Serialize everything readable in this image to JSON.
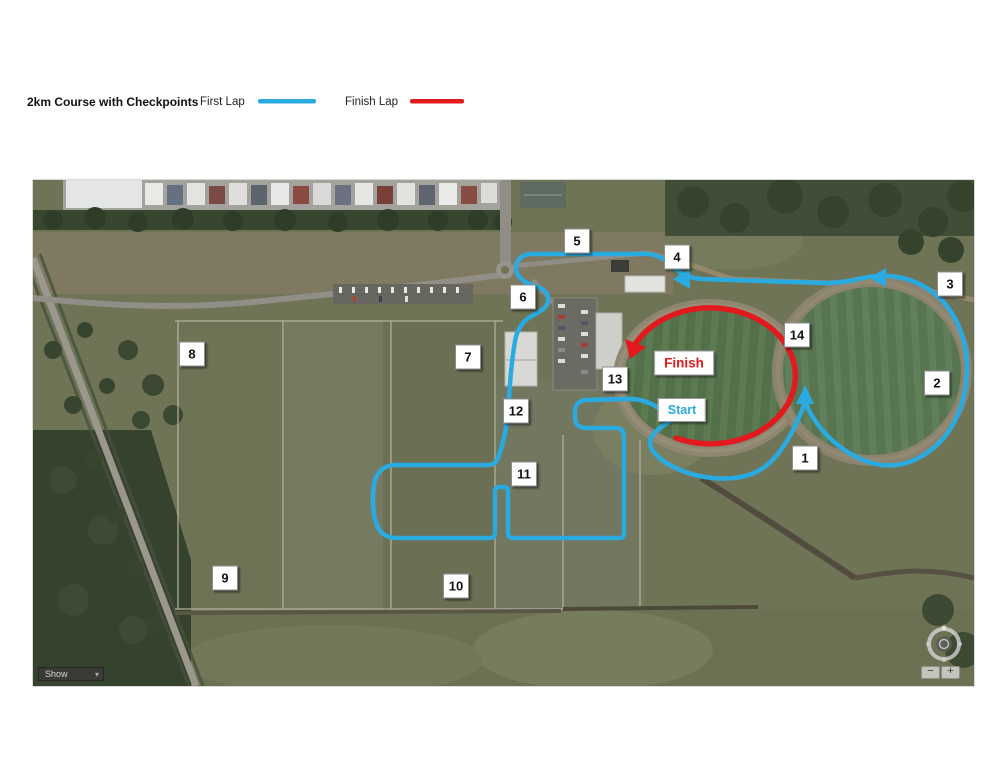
{
  "legend": {
    "title": "2km Course with Checkpoints",
    "items": [
      {
        "label": "First Lap",
        "color": "#29ABE2"
      },
      {
        "label": "Finish Lap",
        "color": "#E21A1E"
      }
    ]
  },
  "map": {
    "start": {
      "text": "Start",
      "x": 649,
      "y": 230
    },
    "finish": {
      "text": "Finish",
      "x": 651,
      "y": 183
    },
    "checkpoints": [
      {
        "number": "1",
        "x": 772,
        "y": 278
      },
      {
        "number": "2",
        "x": 904,
        "y": 203
      },
      {
        "number": "3",
        "x": 917,
        "y": 104
      },
      {
        "number": "4",
        "x": 644,
        "y": 77
      },
      {
        "number": "5",
        "x": 544,
        "y": 61
      },
      {
        "number": "6",
        "x": 490,
        "y": 117
      },
      {
        "number": "7",
        "x": 435,
        "y": 177
      },
      {
        "number": "8",
        "x": 159,
        "y": 174
      },
      {
        "number": "9",
        "x": 192,
        "y": 398
      },
      {
        "number": "10",
        "x": 423,
        "y": 406
      },
      {
        "number": "11",
        "x": 491,
        "y": 294
      },
      {
        "number": "12",
        "x": 483,
        "y": 231
      },
      {
        "number": "13",
        "x": 582,
        "y": 199
      },
      {
        "number": "14",
        "x": 764,
        "y": 155
      }
    ],
    "controls": {
      "layers_label": "Show",
      "zoom_in": "+",
      "zoom_out": "−"
    }
  }
}
